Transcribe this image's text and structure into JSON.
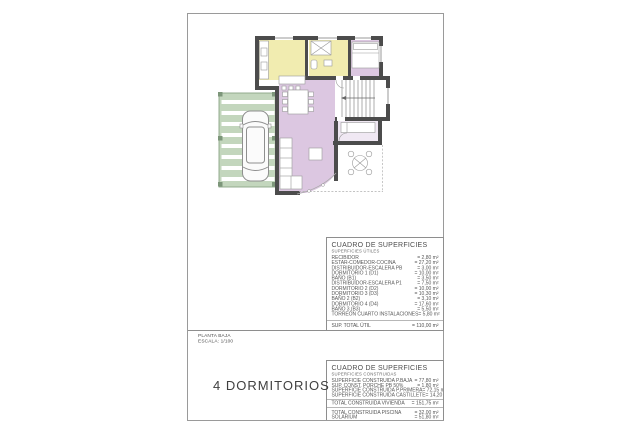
{
  "sheet": {
    "title_block": {
      "line1": "PLANTA BAJA",
      "line2": "ESCALA: 1/100"
    },
    "caption": "4 DORMITORIOS"
  },
  "tables": {
    "utiles": {
      "title": "CUADRO DE SUPERFICIES",
      "subtitle": "SUPERFICIES ÚTILES",
      "rows": [
        {
          "label": "RECIBIDOR",
          "value": "= 2,80 m²"
        },
        {
          "label": "ESTAR-COMEDOR-COCINA",
          "value": "= 27,20 m²"
        },
        {
          "label": "DISTRIBUIDOR-ESCALERA PB",
          "value": "= 3,00 m²"
        },
        {
          "label": "DORMITORIO 1 (D1)",
          "value": "= 10,00 m²"
        },
        {
          "label": "BAÑO (B1)",
          "value": "= 3,50 m²"
        },
        {
          "label": "DISTRIBUIDOR-ESCALERA P1",
          "value": "= 7,50 m²"
        },
        {
          "label": "DORMITORIO 2 (D2)",
          "value": "= 10,00 m²"
        },
        {
          "label": "DORMITORIO 3 (D3)",
          "value": "= 10,30 m²"
        },
        {
          "label": "BAÑO 2 (B2)",
          "value": "= 3,10 m²"
        },
        {
          "label": "DORMITORIO 4 (D4)",
          "value": "= 17,60 m²"
        },
        {
          "label": "BAÑO 3 (B3)",
          "value": "= 5,50 m²"
        },
        {
          "label": "TORREÓN CUARTO INSTALACIONES",
          "value": "= 5,80 m²"
        }
      ],
      "total": {
        "label": "SUP. TOTAL ÚTIL",
        "value": "= 110,00 m²"
      }
    },
    "construidas": {
      "title": "CUADRO DE SUPERFICIES",
      "subtitle": "SUPERFICIES CONSTRUIDAS",
      "rows": [
        {
          "label": "SUPERFICIE CONSTRUIDA P.BAJA",
          "value": "= 77,80 m²"
        },
        {
          "label": "SUP. CONST. PORCHE PB 50%",
          "value": "= 1,80 m²"
        },
        {
          "label": "SUPERFICIE CONSTRUIDA P.PRIMERA",
          "value": "= 72,15 m²"
        },
        {
          "label": "SUPERFICIE CONSTRUIDA CASTILLETE",
          "value": "= 14,20 m²"
        }
      ],
      "total": {
        "label": "TOTAL CONSTRUIDA VIVIENDA",
        "value": "= 151,75 m²"
      },
      "extra_rows": [
        {
          "label": "TOTAL CONSTRUIDA PISCINA",
          "value": "= 32,00 m²"
        },
        {
          "label": "SOLARIUM",
          "value": "= 51,80 m²"
        }
      ]
    }
  },
  "plan": {
    "rooms": [
      "kitchen",
      "bathroom",
      "bedroom",
      "living-dining",
      "stairs",
      "bedroom-2",
      "terrace",
      "pergola-carport"
    ],
    "colors": {
      "room_yellow": "#f1ecb0",
      "room_lilac": "#dcc7e1",
      "room_pale_lilac": "#f0e8f3",
      "pergola_green": "#c3d6bd",
      "pergola_post": "#7d967a",
      "wall": "#4c4c4c"
    }
  }
}
